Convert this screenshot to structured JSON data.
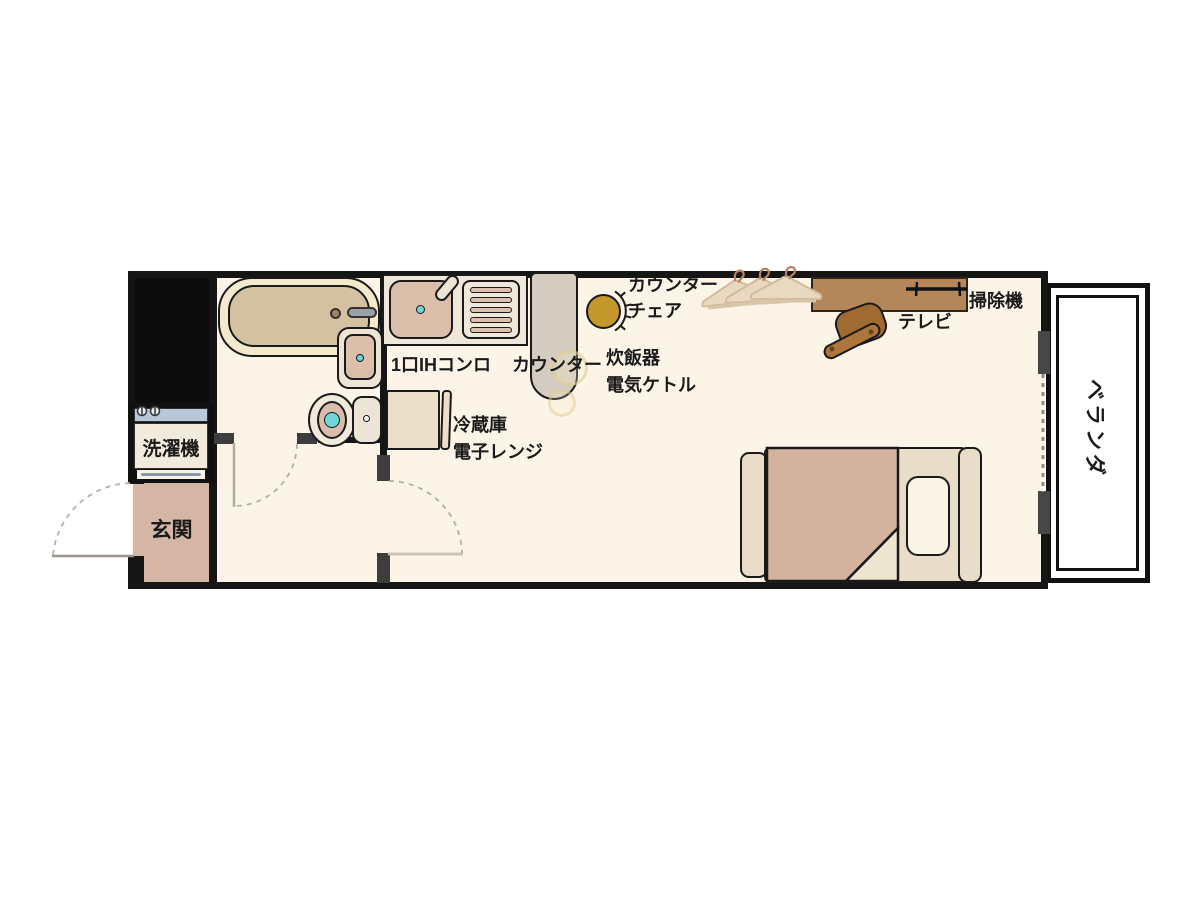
{
  "floor_plan": {
    "type": "studio-apartment-floor-plan",
    "labels": {
      "washing_machine": "洗濯機",
      "entrance": "玄関",
      "ih_stove": "1口IHコンロ",
      "counter": "カウンター",
      "counter_chair_line1": "カウンター",
      "counter_chair_line2": "チェア",
      "rice_cooker": "炊飯器",
      "electric_kettle": "電気ケトル",
      "refrigerator": "冷蔵庫",
      "microwave": "電子レンジ",
      "tv": "テレビ",
      "vacuum_cleaner": "掃除機",
      "balcony": "ベランダ"
    },
    "colors": {
      "wall": "#151515",
      "floor": "#fcf4e7",
      "entrance_floor": "#d5b5a3",
      "bathtub_rim": "#f4e9cd",
      "bathtub_fill": "#d4c1a1",
      "fixture_pink": "#dcbfab",
      "fixture_cream": "#ece4d4",
      "water_cyan": "#6ed7da",
      "counter_gray": "#d5ccc1",
      "chair_gold": "#c3992e",
      "desk_brown": "#b3875a",
      "desk_chair_brown": "#a06b33",
      "bed_cream": "#e7ddc8",
      "blanket_tan": "#d3b39e",
      "pillow_cream": "#fbf5e7",
      "washer_top_blue": "#b7c8da",
      "hanger_tan": "#e9d9c1"
    }
  }
}
